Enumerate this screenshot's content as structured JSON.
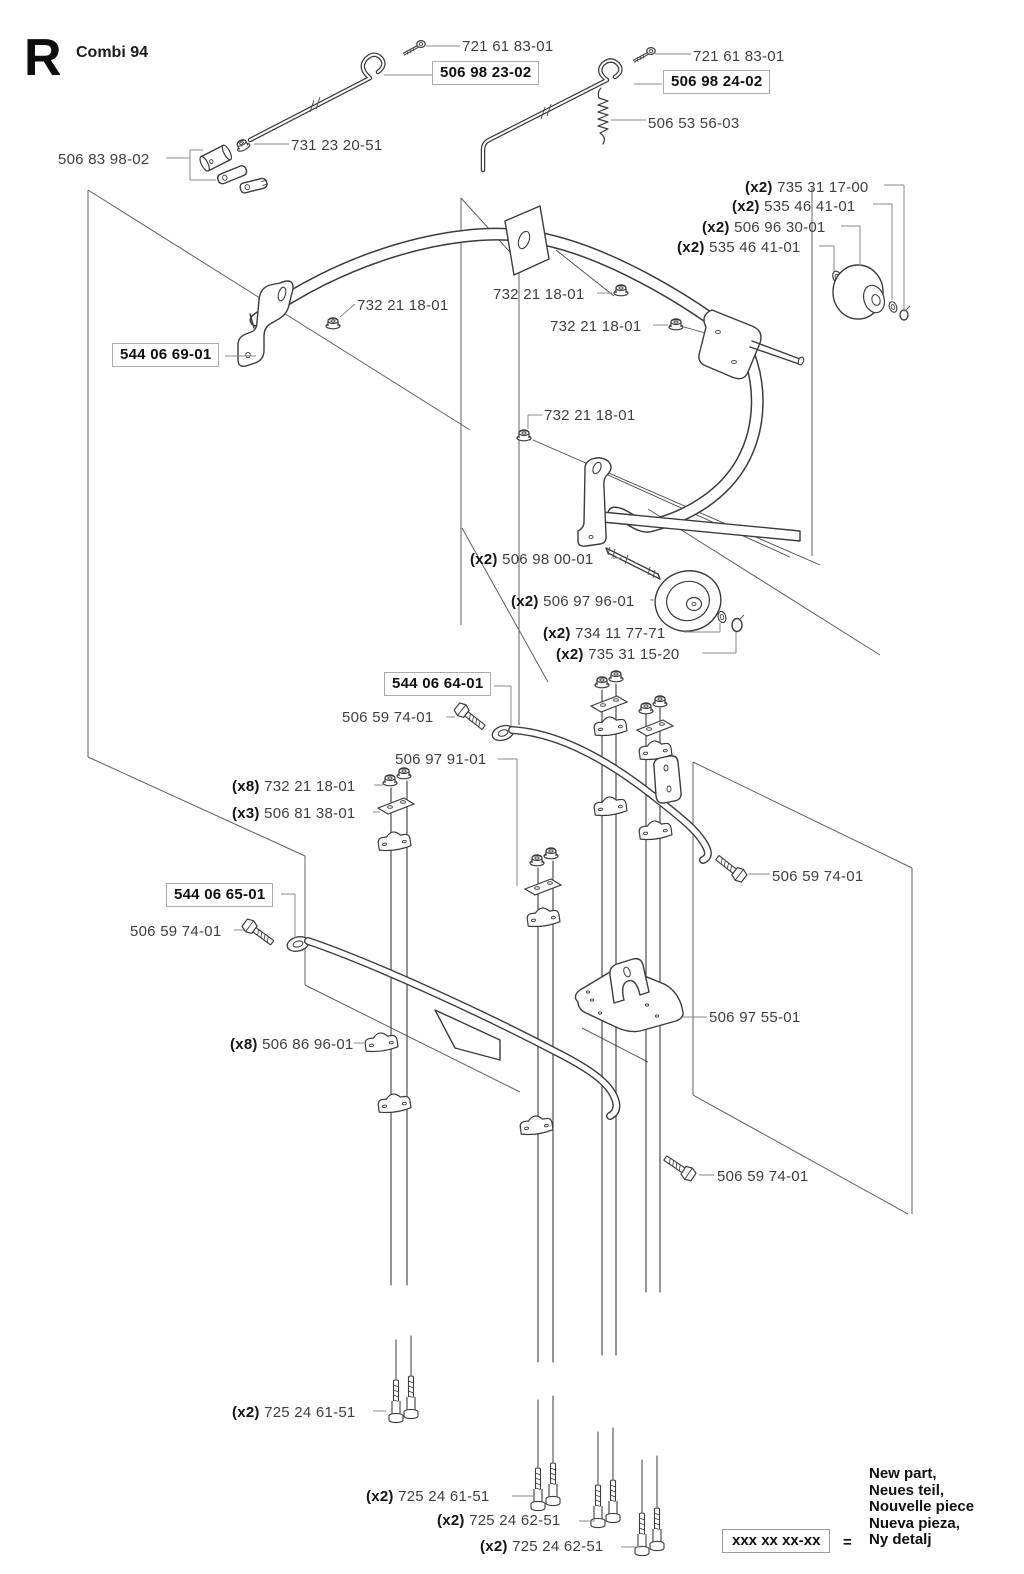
{
  "page": {
    "section_letter": "R",
    "title": "Combi 94"
  },
  "labels": [
    {
      "part": "721 61 83-01",
      "x": 462,
      "y": 38
    },
    {
      "part": "506 98 23-02",
      "x": 432,
      "y": 61,
      "boxed": true
    },
    {
      "part": "721 61 83-01",
      "x": 693,
      "y": 48
    },
    {
      "part": "506 98 24-02",
      "x": 663,
      "y": 70,
      "boxed": true
    },
    {
      "part": "506 53 56-03",
      "x": 648,
      "y": 115
    },
    {
      "part": "731 23 20-51",
      "x": 291,
      "y": 137
    },
    {
      "part": "506 83 98-02",
      "x": 58,
      "y": 151
    },
    {
      "qty": "(x2)",
      "part": "735 31 17-00",
      "x": 745,
      "y": 179
    },
    {
      "qty": "(x2)",
      "part": "535 46 41-01",
      "x": 732,
      "y": 198
    },
    {
      "qty": "(x2)",
      "part": "506 96 30-01",
      "x": 702,
      "y": 219
    },
    {
      "qty": "(x2)",
      "part": "535 46 41-01",
      "x": 677,
      "y": 239
    },
    {
      "part": "732 21 18-01",
      "x": 357,
      "y": 297
    },
    {
      "part": "732 21 18-01",
      "x": 493,
      "y": 286
    },
    {
      "part": "732 21 18-01",
      "x": 550,
      "y": 318
    },
    {
      "part": "732 21 18-01",
      "x": 544,
      "y": 407
    },
    {
      "part": "544 06 69-01",
      "x": 112,
      "y": 343,
      "boxed": true
    },
    {
      "qty": "(x2)",
      "part": "506 98 00-01",
      "x": 470,
      "y": 551
    },
    {
      "qty": "(x2)",
      "part": "506 97 96-01",
      "x": 511,
      "y": 593
    },
    {
      "qty": "(x2)",
      "part": "734 11 77-71",
      "x": 543,
      "y": 625
    },
    {
      "qty": "(x2)",
      "part": "735 31 15-20",
      "x": 556,
      "y": 646
    },
    {
      "part": "544 06 64-01",
      "x": 384,
      "y": 672,
      "boxed": true
    },
    {
      "part": "506 59 74-01",
      "x": 342,
      "y": 709
    },
    {
      "part": "506 97 91-01",
      "x": 395,
      "y": 751
    },
    {
      "qty": "(x8)",
      "part": "732 21 18-01",
      "x": 232,
      "y": 778
    },
    {
      "qty": "(x3)",
      "part": "506 81 38-01",
      "x": 232,
      "y": 805
    },
    {
      "part": "506 59 74-01",
      "x": 772,
      "y": 868
    },
    {
      "part": "544 06 65-01",
      "x": 166,
      "y": 883,
      "boxed": true
    },
    {
      "part": "506 59 74-01",
      "x": 130,
      "y": 923
    },
    {
      "qty": "(x8)",
      "part": "506 86 96-01",
      "x": 230,
      "y": 1036
    },
    {
      "part": "506 97 55-01",
      "x": 709,
      "y": 1009
    },
    {
      "part": "506 59 74-01",
      "x": 717,
      "y": 1168
    },
    {
      "qty": "(x2)",
      "part": "725 24 61-51",
      "x": 232,
      "y": 1404
    },
    {
      "qty": "(x2)",
      "part": "725 24 61-51",
      "x": 366,
      "y": 1488
    },
    {
      "qty": "(x2)",
      "part": "725 24 62-51",
      "x": 437,
      "y": 1512
    },
    {
      "qty": "(x2)",
      "part": "725 24 62-51",
      "x": 480,
      "y": 1538
    }
  ],
  "legend": {
    "box_text": "xxx xx xx-xx",
    "equals": "=",
    "lines": [
      "New part,",
      "Neues teil,",
      "Nouvelle piece",
      "Nueva pieza,",
      "Ny detalj"
    ]
  }
}
